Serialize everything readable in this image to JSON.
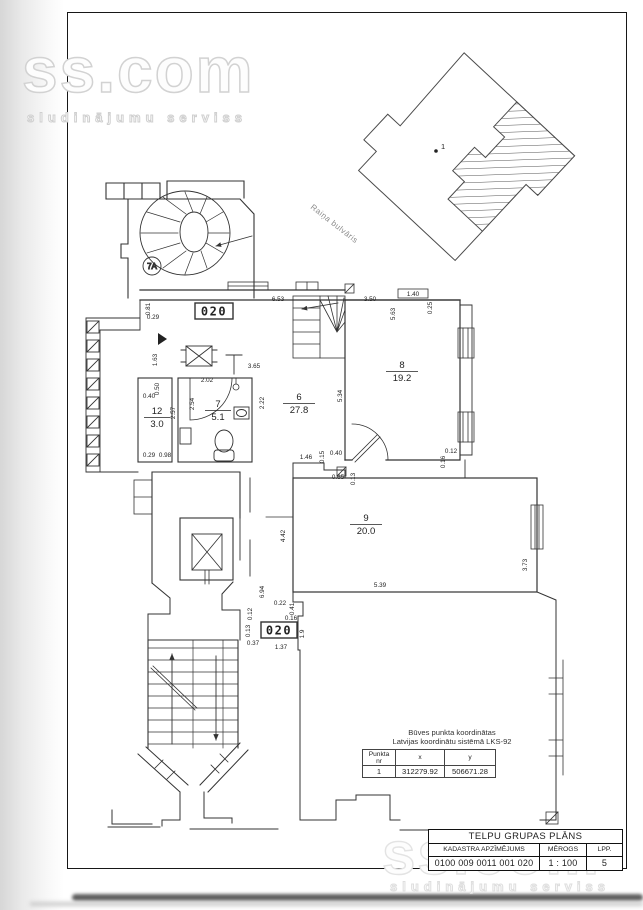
{
  "watermark": {
    "brand": "ss.com",
    "tagline": "sludinājumu serviss"
  },
  "site_plan": {
    "street_label": "Raiņa bulvāris",
    "point_label": "1"
  },
  "floor_plan": {
    "unit_labels": [
      "020",
      "020"
    ],
    "stair_circle_label": "7A",
    "rooms": [
      {
        "nr": "12",
        "area": "3.0",
        "x": 157,
        "y": 414
      },
      {
        "nr": "7",
        "area": "5.1",
        "x": 218,
        "y": 407
      },
      {
        "nr": "6",
        "area": "27.8",
        "x": 299,
        "y": 400
      },
      {
        "nr": "8",
        "area": "19.2",
        "x": 402,
        "y": 368
      },
      {
        "nr": "9",
        "area": "20.0",
        "x": 366,
        "y": 521
      }
    ],
    "dimensions": [
      {
        "t": "6.53",
        "x": 278,
        "y": 301,
        "r": 0
      },
      {
        "t": "3.50",
        "x": 370,
        "y": 301,
        "r": 0
      },
      {
        "t": "1.40",
        "x": 413,
        "y": 296,
        "r": 0
      },
      {
        "t": "0.25",
        "x": 432,
        "y": 308,
        "r": -90
      },
      {
        "t": "5.63",
        "x": 395,
        "y": 314,
        "r": -90
      },
      {
        "t": "5.34",
        "x": 342,
        "y": 396,
        "r": -90
      },
      {
        "t": "3.65",
        "x": 254,
        "y": 368,
        "r": 0
      },
      {
        "t": "2.02",
        "x": 207,
        "y": 382,
        "r": 0
      },
      {
        "t": "2.54",
        "x": 194,
        "y": 404,
        "r": -90
      },
      {
        "t": "2.57",
        "x": 175,
        "y": 413,
        "r": -90
      },
      {
        "t": "0.50",
        "x": 159,
        "y": 389,
        "r": -90
      },
      {
        "t": "0.40",
        "x": 149,
        "y": 398,
        "r": 0
      },
      {
        "t": "2.22",
        "x": 264,
        "y": 403,
        "r": -90
      },
      {
        "t": "1.63",
        "x": 157,
        "y": 360,
        "r": -90
      },
      {
        "t": "0.81",
        "x": 150,
        "y": 309,
        "r": -90
      },
      {
        "t": "0.29",
        "x": 153,
        "y": 319,
        "r": 0
      },
      {
        "t": "0.29",
        "x": 149,
        "y": 457,
        "r": 0
      },
      {
        "t": "0.98",
        "x": 165,
        "y": 457,
        "r": 0
      },
      {
        "t": "1.46",
        "x": 306,
        "y": 459,
        "r": 0
      },
      {
        "t": "0.15",
        "x": 324,
        "y": 457,
        "r": -90
      },
      {
        "t": "0.40",
        "x": 336,
        "y": 455,
        "r": 0
      },
      {
        "t": "0.65",
        "x": 338,
        "y": 479,
        "r": 0
      },
      {
        "t": "0.13",
        "x": 355,
        "y": 479,
        "r": -90
      },
      {
        "t": "0.12",
        "x": 451,
        "y": 453,
        "r": 0
      },
      {
        "t": "0.16",
        "x": 445,
        "y": 462,
        "r": -90
      },
      {
        "t": "4.42",
        "x": 285,
        "y": 536,
        "r": -90
      },
      {
        "t": "5.39",
        "x": 380,
        "y": 587,
        "r": 0
      },
      {
        "t": "3.73",
        "x": 527,
        "y": 565,
        "r": -90
      },
      {
        "t": "6.94",
        "x": 264,
        "y": 592,
        "r": -90
      },
      {
        "t": "0.22",
        "x": 280,
        "y": 605,
        "r": 0
      },
      {
        "t": "0.41",
        "x": 294,
        "y": 609,
        "r": -90
      },
      {
        "t": "0.16",
        "x": 291,
        "y": 620,
        "r": 0
      },
      {
        "t": "1.9",
        "x": 304,
        "y": 634,
        "r": -90
      },
      {
        "t": "1.37",
        "x": 281,
        "y": 649,
        "r": 0
      },
      {
        "t": "0.37",
        "x": 253,
        "y": 645,
        "r": 0
      },
      {
        "t": "0.13",
        "x": 250,
        "y": 631,
        "r": -90
      },
      {
        "t": "0.12",
        "x": 252,
        "y": 614,
        "r": -90
      }
    ]
  },
  "coordinates_table": {
    "title_line1": "Būves punkta koordinātas",
    "title_line2": "Latvijas koordinātu sistēmā LKS-92",
    "headers": {
      "point": "Punkta nr",
      "x": "x",
      "y": "y"
    },
    "rows": [
      {
        "nr": "1",
        "x": "312279.92",
        "y": "506671.28"
      }
    ]
  },
  "title_block": {
    "title": "TELPU GRUPAS PLĀNS",
    "cadastre_label": "KADASTRA APZĪMĒJUMS",
    "scale_label": "MĒROGS",
    "page_label": "LPP.",
    "cadastre_value": "0100 009 0011 001 020",
    "scale_value": "1 : 100",
    "page_value": "5"
  }
}
